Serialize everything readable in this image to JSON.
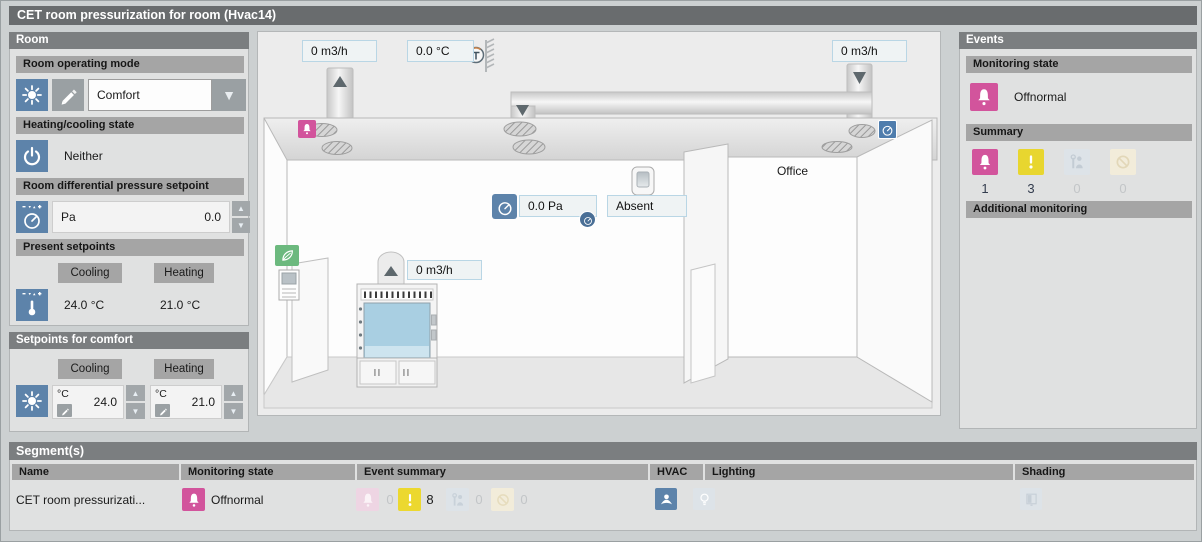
{
  "title": "CET room pressurization for room (Hvac14)",
  "room": {
    "header": "Room",
    "operating_mode": {
      "label": "Room operating mode",
      "value": "Comfort"
    },
    "heating_cooling": {
      "label": "Heating/cooling state",
      "value": "Neither"
    },
    "diff_pressure": {
      "label": "Room differential pressure setpoint",
      "unit": "Pa",
      "value": "0.0"
    },
    "present": {
      "label": "Present setpoints",
      "cooling": "Cooling",
      "heating": "Heating",
      "cooling_value": "24.0 °C",
      "heating_value": "21.0 °C"
    }
  },
  "comfort": {
    "header": "Setpoints for comfort",
    "cooling": "Cooling",
    "heating": "Heating",
    "cooling_unit": "°C",
    "cooling_value": "24.0",
    "heating_unit": "°C",
    "heating_value": "21.0"
  },
  "graphic": {
    "exhaust_flow": "0 m3/h",
    "supply_temp": "0.0 °C",
    "office_flow": "0 m3/h",
    "hood_flow": "0 m3/h",
    "room_pressure": "0.0 Pa",
    "presence": "Absent",
    "office_label": "Office"
  },
  "events": {
    "header": "Events",
    "monitoring_label": "Monitoring state",
    "monitoring_value": "Offnormal",
    "summary_label": "Summary",
    "summary": [
      {
        "name": "alarm",
        "count": "1"
      },
      {
        "name": "warning",
        "count": "3"
      },
      {
        "name": "maintenance",
        "count": "0"
      },
      {
        "name": "out-of-service",
        "count": "0"
      }
    ],
    "additional_label": "Additional monitoring"
  },
  "segments": {
    "header": "Segment(s)",
    "columns": [
      "Name",
      "Monitoring state",
      "Event summary",
      "HVAC",
      "Lighting",
      "Shading"
    ],
    "row": {
      "name": "CET room pressurizati...",
      "monitoring": "Offnormal",
      "events": [
        {
          "name": "alarm",
          "count": "0"
        },
        {
          "name": "warning",
          "count": "8"
        },
        {
          "name": "maintenance",
          "count": "0"
        },
        {
          "name": "out-of-service",
          "count": "0"
        }
      ]
    }
  },
  "icons": [
    "sun-icon",
    "pencil-icon",
    "dropdown-arrow-icon",
    "power-icon",
    "gauge-icon",
    "thermometer-icon",
    "alarm-bell-icon",
    "warning-icon",
    "maintenance-icon",
    "out-of-service-icon",
    "leaf-icon",
    "hvac-icon",
    "lighting-icon",
    "shading-icon",
    "temperature-sensor-icon",
    "damper-icon",
    "presence-detector-icon"
  ],
  "colors": {
    "accent_blue": "#5d83aa",
    "alarm_pink": "#d2549c",
    "warning_yellow": "#e8d62f",
    "eco_green": "#6cb97e",
    "faded_pink": "#eed5e3",
    "faded_blue": "#dde3e8",
    "faded_tan": "#f2ecda"
  }
}
